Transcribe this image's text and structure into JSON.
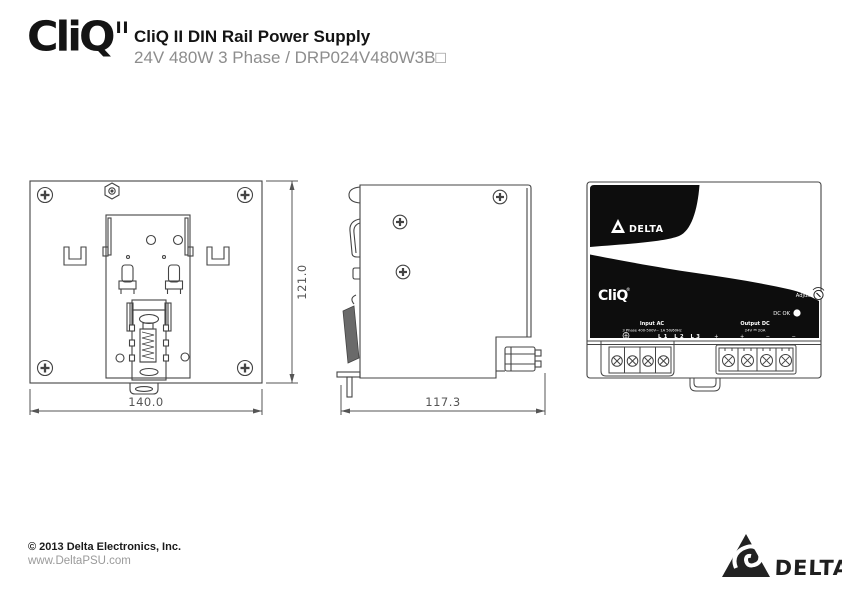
{
  "header": {
    "logo": "CliQ",
    "logo_sup": "II",
    "title": "CliQ II DIN Rail Power Supply",
    "subtitle": "24V 480W 3 Phase / DRP024V480W3B□"
  },
  "drawings": {
    "back": {
      "width_dim": "140.0",
      "height_dim": "121.0"
    },
    "side": {
      "depth_dim": "117.3"
    },
    "front": {
      "brand": "DELTA",
      "logo": "CliQ",
      "logo_reg": "®",
      "adjust": "Adjust",
      "dc_ok": "DC OK",
      "input_title": "Input AC",
      "input_spec": "3 Phase 400-500V~ 1A 50/60Hz",
      "input_terminals": "L1 L2 L3",
      "output_title": "Output DC",
      "output_spec": "24V ⎓ 20A",
      "output_polarity": "+ + − −"
    }
  },
  "footer": {
    "copyright": "© 2013 Delta Electronics, Inc.",
    "website": "www.DeltaPSU.com",
    "brand": "DELTA"
  }
}
